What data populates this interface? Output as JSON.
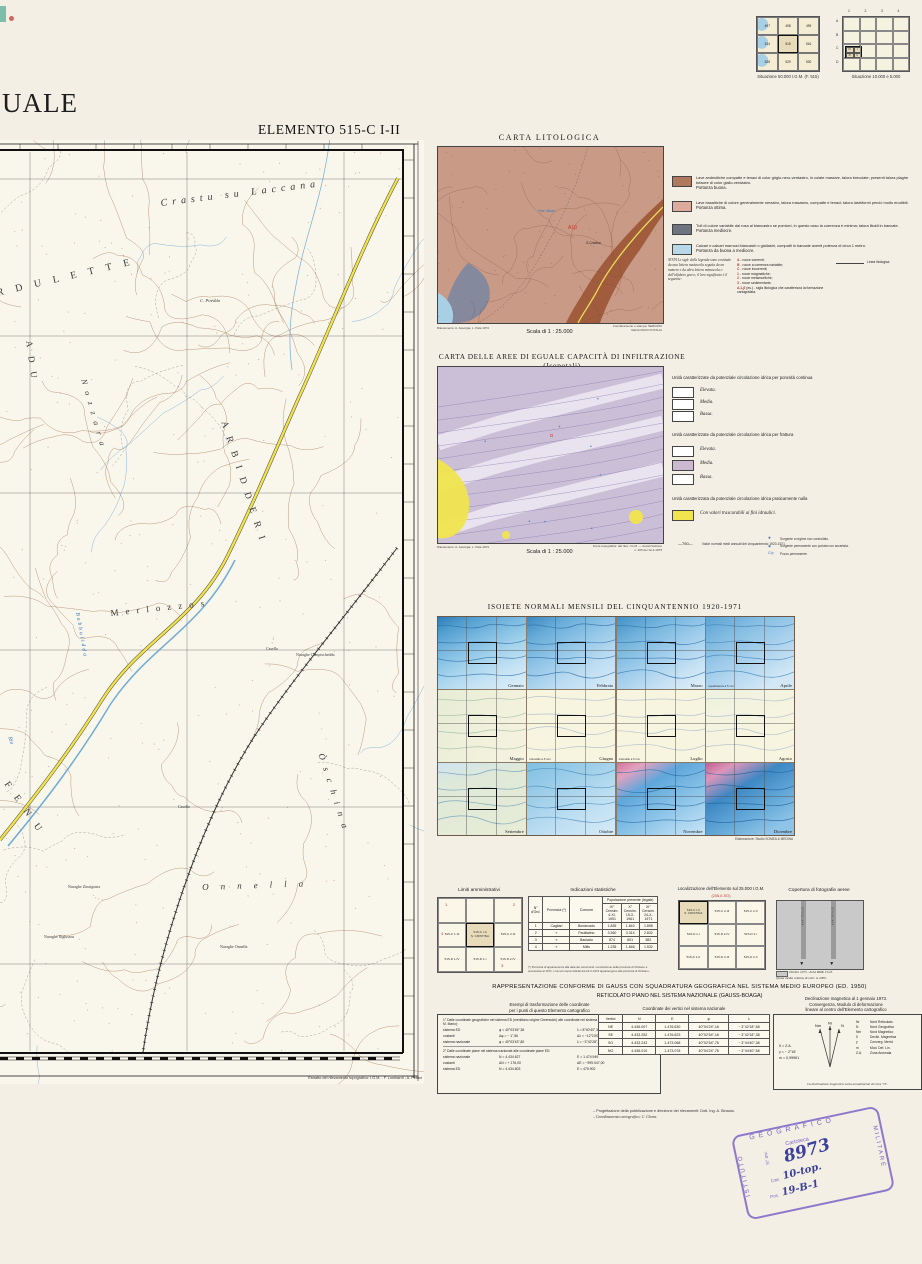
{
  "situazione50": {
    "caption": "Situazione 50.000 I.G.M. (F. 515)",
    "cells": [
      "497",
      "498",
      "499",
      "514",
      "515",
      "516",
      "528",
      "529",
      "530"
    ],
    "highlight": "515"
  },
  "situazione10": {
    "caption": "Situazione 10.000 e 5.000",
    "cols": [
      "1",
      "2",
      "3",
      "4"
    ],
    "rows": [
      "A",
      "B",
      "C",
      "D"
    ],
    "mini": [
      "IV",
      "I",
      "III",
      "II"
    ]
  },
  "title_fragment": "UALE",
  "element_label": "ELEMENTO 515-C I-II",
  "main_map": {
    "labels": [
      {
        "text": "Crastu  su  Laccana"
      },
      {
        "text": "RDULETTE"
      },
      {
        "text": "C. Piredda"
      },
      {
        "text": "ADU"
      },
      {
        "text": "Nozzara"
      },
      {
        "text": "ARBIDDERI"
      },
      {
        "text": "Merlozzos"
      },
      {
        "text": "Bubbulidda"
      },
      {
        "text": "Riu"
      },
      {
        "text": "Casella"
      },
      {
        "text": "Nuraghe Campischeddu"
      },
      {
        "text": "Òschina"
      },
      {
        "text": "Casello"
      },
      {
        "text": "FENU"
      },
      {
        "text": "Nuraghe Zinzigonia"
      },
      {
        "text": "Onnella"
      },
      {
        "text": "Nuraghe Ilighozzu"
      },
      {
        "text": "Nuraghe Onnella"
      }
    ],
    "credit": "Estratto del rilevamento topografico: I.G.M. - F. Lombardi ; A. Petrini"
  },
  "carta_litologica": {
    "title": "CARTA LITOLOGICA",
    "scala": "Scala di 1 : 25.000",
    "credit_left": "Rilevamento: A. Assorgia, L. Pala 1973",
    "credit_right": "Coordinamento e stampa: SERVIZIO GEOLOGICO D'ITALIA",
    "map_label_red": "A1β",
    "map_label_black": "S.Cristina",
    "map_label_blue": "Funt. Mauru",
    "legend": [
      {
        "color": "#b0785e",
        "text": "Lave andesitiche compatte e tenaci di color grigio-nero-verdastro, in colate massive, talora brecciate; presenti talora plaghe tufacee di color giallo-verdastro.",
        "portanza": "Portanza buona."
      },
      {
        "color": "#dcab9b",
        "text": "Lave basaltiche di colore generalmente nerastro, talora rossastro, compatte e tenaci; talora lastriformi perciò molto erodibili.",
        "portanza": "Portanza ottima."
      },
      {
        "color": "#6e7480",
        "text": "Tufi di colore variabile dal rosa al biancastro se pomicei, in questo caso la coerenza è minima; talora litoidi in bancate.",
        "portanza": "Portanza mediocre."
      },
      {
        "color": "#b8d8e8",
        "text": "Calcari e calcari marnosi biancastri o giallastri, compatti in bancate aventi potenza di circa 1 metro.",
        "portanza": "Portanza da buona a mediocre."
      }
    ],
    "nota_intro": "NOTA Le sigle della legenda sono costituite da una lettera maiuscola seguita da un numero e da altra lettera minuscola o dell'alfabeto greco; il loro significato è il seguente:",
    "nota_items": [
      {
        "sym": "A",
        "txt": "- rocce coerenti;"
      },
      {
        "sym": "B",
        "txt": "- rocce a coerenza variabile;"
      },
      {
        "sym": "C",
        "txt": "- rocce incoerenti;"
      },
      {
        "sym": "1",
        "txt": "- rocce magmatiche;"
      },
      {
        "sym": "2",
        "txt": "- rocce metamorfiche;"
      },
      {
        "sym": "3",
        "txt": "- rocce sedimentarie;"
      },
      {
        "sym": "A,1,β",
        "txt": "(es.) - sigla litologica che caratterizza la formazione cartografata."
      }
    ],
    "linea_label": "Linea litologica"
  },
  "carta_infiltrazione": {
    "title": "CARTA DELLE AREE DI EGUALE CAPACITÀ DI INFILTRAZIONE (Isopotali)",
    "scala": "Scala di 1 : 25.000",
    "credit_left": "Rilevamento: A. Assorgia, L. Pala 1973",
    "credit_right": "Fonte topografica: dal rilev. I.G.M. — Autorizzazione n. 465 del 12-4-1975",
    "map_label_red": "α",
    "groups": [
      {
        "heading": "Unità caratterizzate da potenziale circolazione idrica per porosità continua",
        "items": [
          {
            "label": "Elevata.",
            "color": "#ffffff"
          },
          {
            "label": "Media.",
            "color": "#ffffff"
          },
          {
            "label": "Bassa.",
            "color": "#ffffff"
          }
        ]
      },
      {
        "heading": "Unità caratterizzate da potenziale circolazione idrica per frattura",
        "items": [
          {
            "label": "Elevata.",
            "color": "#ffffff"
          },
          {
            "label": "Media.",
            "color": "#cdb8d2"
          },
          {
            "label": "Bassa.",
            "color": "#ffffff"
          }
        ]
      },
      {
        "heading": "Unità caratterizzata da potenziale circolazione idrica praticamente nulla",
        "items": [
          {
            "label": "Con valori trascurabili ai fini idraulici.",
            "color": "#f2e44e"
          }
        ]
      }
    ],
    "isoieta_symbol": "—750—",
    "isoieta_text": "Valori normali medi annuali del cinquantennio 1920-1971",
    "symbols": [
      {
        "glyph": "✚",
        "text": "Sorgente a regime non controllato."
      },
      {
        "glyph": "◉",
        "text": "Sorgente permanente con portata non accertata."
      },
      {
        "glyph": "C/p",
        "text": "Pozzo permanente."
      }
    ]
  },
  "isoiete": {
    "title": "ISOIETE NORMALI MENSILI DEL CINQUANTENNIO 1920-1971",
    "months": [
      "Gennaio",
      "Febbraio",
      "Marzo",
      "Aprile",
      "Maggio",
      "Giugno",
      "Luglio",
      "Agosto",
      "Settembre",
      "Ottobre",
      "Novembre",
      "Dicembre"
    ],
    "note_aprile": "equidistanza a 5 mm",
    "note_giugno": "intervallo a 5 mm",
    "note_luglio": "intervallo a 5 mm",
    "credit": "Elaborazione: Studio SOMEA & MEDINA"
  },
  "limiti": {
    "title": "Limiti amministrativi",
    "r2c1": "515-C 1-III",
    "center1": "515-C I-II",
    "center2": "S. CRISTINA",
    "r2c3": "515-C 2-III",
    "r3c1": "515-D 1-IV",
    "r3c2": "515-D 1-I",
    "r3c3": "515-D 2-IV",
    "n1": "1",
    "n2": "2",
    "n3": "3",
    "n4": "4"
  },
  "statistiche": {
    "title": "Indicazioni statistiche",
    "col_ord": "N° d'Ord.",
    "col_prov": "Provincia (*)",
    "col_com": "Comune",
    "col_pop": "Popolazione presente (legale)",
    "col_c1": "IX° Censim. 4-XI-1951",
    "col_c2": "X° Censim. 15-X-1961",
    "col_c3": "XI° Censim. 24-X-1971",
    "rows": [
      {
        "n": "1",
        "prov": "Cagliari",
        "com": "Bonàrcado",
        "c1": "1.835",
        "c2": "1.843",
        "c3": "1.898"
      },
      {
        "n": "2",
        "prov": "«",
        "com": "Paulilatino",
        "c1": "3.360",
        "c2": "3.314",
        "c3": "2.832"
      },
      {
        "n": "3",
        "prov": "«",
        "com": "Bauladu",
        "c1": "874",
        "c2": "801",
        "c3": "582"
      },
      {
        "n": "4",
        "prov": "«",
        "com": "Milis",
        "c1": "1.235",
        "c2": "1.846",
        "c3": "1.532"
      }
    ],
    "footnote": "(*) Provincia di appartenenza alla data dei censimenti. La istituzione della provincia di Oristano è successiva al 1971; i comuni sopra indicati dal 24-X-1974 appartengono alla provincia di Oristano."
  },
  "localizzazione": {
    "title": "Localizzazione dell'Elemento sul 25.000 I.G.M.",
    "subtitle": "(206-II-SO)",
    "c1a": "515-C I-II",
    "c1b": "S. CRISTINA",
    "r1c2": "515-C 2-III",
    "r1c3": "515-C 2-II",
    "r2c1": "515-D 1-I",
    "r2c2": "515-D 2-IV",
    "r2c3": "515-D 2-I",
    "r3c1": "515-D 1-II",
    "r3c2": "515-D 2-III",
    "r3c3": "515-D 2-II"
  },
  "copertura": {
    "title": "Copertura di fotografie aeree",
    "strip_label": "STRISCIATA",
    "caption1": "Ottobre 1973 - Zeiss RMK 15/23.",
    "caption2": "Quota media relativa di volo: m 2000."
  },
  "gauss": {
    "line1": "RAPPRESENTAZIONE CONFORME DI GAUSS CON SQUADRATURA GEOGRAFICA NEL SISTEMA MEDIO EUROPEO (ED. 1950)",
    "line2": "RETICOLATO PIANO NEL SISTEMA NAZIONALE (GAUSS-BOAGA)"
  },
  "esempi": {
    "heading1": "Esempi di trasformazione delle coordinate",
    "heading2": "per i punti di questo Elemento cartografico",
    "p1": "1° Dalle coordinate geografiche nel sistema ED (meridiano origine Greenwich) alle coordinate nel sistema nazionale (meridiano origine Roma - M. Mario):",
    "r1a": "sistema ED",
    "r1b": "φ =  40°03'45\",36",
    "r1c": "λ =  8°40'40\",39",
    "r2a": "costanti",
    "r2b": "Δφ = −  1\",56",
    "r2c": "Δλ = −12°23'08\",94",
    "r3a": "sistema nazionale",
    "r3b": "φ =  40°03'43\",80",
    "r3c": "λ = −3°42'28\",55",
    "p2": "2° Dalle coordinate piane nel sistema nazionale alle coordinate piane ED:",
    "r4a": "sistema nazionale",
    "r4b": "N =  4.434.627",
    "r4c": "E =  1.474.949",
    "r5a": "costanti",
    "r5b": "ΔN = +  176,00",
    "r5c": "ΔE = −999.047,00",
    "r6a": "sistema ED",
    "r6b": "N =  4.434.803",
    "r6c": "E =  475.902"
  },
  "vertici": {
    "heading": "Coordinate dei vertici nel sistema nazionale",
    "cols": [
      "Vertici",
      "N",
      "E",
      "φ",
      "λ"
    ],
    "rows": [
      [
        "NE",
        "4.436.007",
        "1.476.630",
        "40°04'24\",16",
        "− 3°42'18\",58"
      ],
      [
        "SE",
        "4.433.252",
        "1.476.623",
        "40°02'54\",16",
        "− 3°42'18\",38"
      ],
      [
        "SO",
        "4.433.243",
        "1.473.068",
        "40°02'54\",76",
        "− 3°44'40\",38"
      ],
      [
        "NO",
        "4.436.010",
        "1.473.078",
        "40°04'24\",76",
        "− 3°44'40\",58"
      ]
    ]
  },
  "declinazione": {
    "heading1": "Declinazione magnetica al 1 gennaio 1973.",
    "heading2": "Convergenza, Modulo di deformazione",
    "heading3": "lineare al centro dell'Elemento cartografico",
    "v1": "δ = Z.A.",
    "v2": "γ = − 2°18'",
    "v3": "m = 0,99961",
    "legend": [
      {
        "k": "Nr",
        "v": "Nord Reticolato"
      },
      {
        "k": "N",
        "v": "Nord Geografico"
      },
      {
        "k": "Nm",
        "v": "Nord Magnetico"
      },
      {
        "k": "δ",
        "v": "Declin. Magnetica"
      },
      {
        "k": "γ",
        "v": "Converg. Merid."
      },
      {
        "k": "m",
        "v": "Mod. Def. Lin."
      },
      {
        "k": "Z.A.",
        "v": "Zona Anomala"
      }
    ],
    "footnote": "La declinazione magnetica varia annualmente di circa +6'."
  },
  "footnotes": {
    "f1": "– Progettazione della pubblicazione e direzione dei rilevamenti: Dott. Ing. A. Binacia.",
    "f2": "– Coordinamento cartografico: C. Gloria."
  },
  "stamp": {
    "top": "GEOGRAFICO",
    "left": "ISTITUTO",
    "right": "MILITARE",
    "line1": "Cartoteca",
    "inv_label": "N° Inv.",
    "inv": "8973",
    "cas_label": "Cas.",
    "cas": "10-top.",
    "pos_label": "Pos.",
    "pos": "19-B-1"
  }
}
